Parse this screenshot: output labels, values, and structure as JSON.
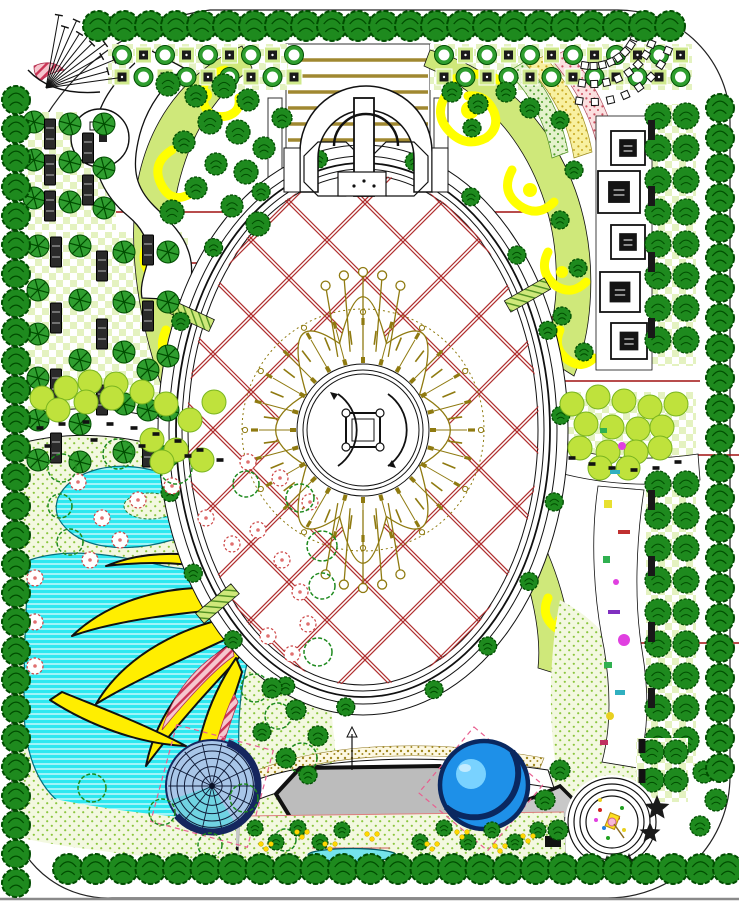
{
  "title": "landscape-master-plan",
  "canvas": {
    "width": 739,
    "height": 911
  },
  "palette": {
    "line": "#111111",
    "redLine": "#a01010",
    "latticeRed": "#b03030",
    "treeDark": "#1e8a1e",
    "treeDarkEdge": "#004d00",
    "treeMid": "#2f9e2f",
    "treeLight": "#bfe23c",
    "treeLightEdge": "#7ab520",
    "checkerLight": "#e4f2c0",
    "bandGreen": "#cfe87a",
    "yellow": "#ffee00",
    "swirlYellow": "#ffff00",
    "water": "#2ee8f0",
    "waterEdge": "#056c7c",
    "domeBase": "#a8c6e8",
    "domeRim": "#15265e",
    "domeCyan": "#58d8e0",
    "poolBlue": "#1e90e8",
    "poolLight": "#79d2ff",
    "poolRim": "#0a2860",
    "olive": "#8f7a10",
    "tan": "#a08830",
    "stageGray": "#bcbcbc",
    "walkGray": "#c8c8c8",
    "pinkFill": "#f6c6ce",
    "pinkEdge": "#cc3355",
    "vegBg": "#f3f8e0",
    "vegDot": "#8cc63f",
    "speckYellowBg": "#f8f0a0",
    "speckYellowDot": "#c8a820",
    "speckPinkBg": "#fbe0e0",
    "speckPinkDot": "#cc5060",
    "speckGreenBg": "#e4f2cc",
    "speckGreenDot": "#4e9e28",
    "magenta": "#e040e0",
    "khakiDot": "#a08820"
  },
  "features": {
    "treeBorders": [
      {
        "x": 98,
        "y": 26,
        "dx": 26,
        "dy": 0,
        "n": 23,
        "r": 15
      },
      {
        "x": 16,
        "y": 100,
        "dx": 0,
        "dy": 29,
        "n": 28,
        "r": 14
      },
      {
        "x": 720,
        "y": 108,
        "dx": 0,
        "dy": 30,
        "n": 23,
        "r": 14
      },
      {
        "x": 68,
        "y": 869,
        "dx": 27.5,
        "dy": 0,
        "n": 25,
        "r": 15
      }
    ],
    "topGrid": {
      "rows": [
        55,
        77
      ],
      "cell": 21.5,
      "runs": [
        {
          "x0": 112,
          "n": 9
        },
        {
          "x0": 434,
          "n": 12
        }
      ]
    },
    "leftGridBenches": [
      [
        56,
        252
      ],
      [
        56,
        318
      ],
      [
        56,
        384
      ],
      [
        56,
        448
      ],
      [
        102,
        266
      ],
      [
        102,
        334
      ],
      [
        102,
        400
      ],
      [
        148,
        250
      ],
      [
        148,
        316
      ],
      [
        148,
        452
      ],
      [
        50,
        134
      ],
      [
        50,
        170
      ],
      [
        50,
        206
      ],
      [
        88,
        148
      ],
      [
        88,
        190
      ]
    ],
    "leftGridStars": [
      [
        38,
        246
      ],
      [
        38,
        290
      ],
      [
        38,
        334
      ],
      [
        38,
        378
      ],
      [
        38,
        420
      ],
      [
        38,
        460
      ],
      [
        80,
        246
      ],
      [
        80,
        300
      ],
      [
        80,
        360
      ],
      [
        80,
        424
      ],
      [
        80,
        462
      ],
      [
        124,
        252
      ],
      [
        124,
        302
      ],
      [
        124,
        352
      ],
      [
        124,
        404
      ],
      [
        124,
        452
      ],
      [
        168,
        252
      ],
      [
        168,
        302
      ],
      [
        168,
        356
      ],
      [
        168,
        410
      ],
      [
        168,
        456
      ],
      [
        148,
        370
      ],
      [
        148,
        410
      ],
      [
        34,
        122
      ],
      [
        34,
        160
      ],
      [
        34,
        198
      ],
      [
        70,
        124
      ],
      [
        70,
        162
      ],
      [
        70,
        202
      ],
      [
        104,
        124
      ],
      [
        104,
        168
      ],
      [
        104,
        208
      ]
    ],
    "fan": {
      "ax": 46,
      "ay": 88,
      "a0": -80,
      "a1": -8,
      "n": 11,
      "len": 74
    },
    "pavilions": [
      [
        628,
        148,
        34
      ],
      [
        619,
        192,
        42
      ],
      [
        628,
        242,
        34
      ],
      [
        620,
        292,
        40
      ],
      [
        629,
        341,
        36
      ]
    ],
    "rightCols": {
      "xs": [
        658,
        686
      ],
      "runs": [
        {
          "y0": 116,
          "n": 8
        },
        {
          "y0": 484,
          "n": 9
        }
      ],
      "step": 32,
      "r": 13
    },
    "rightColBenches": [
      130,
      196,
      262,
      328,
      500,
      566,
      632,
      698
    ],
    "paverFan": {
      "cx": 592,
      "cy": 20,
      "radii": [
        46,
        64,
        82
      ],
      "a0": 22,
      "a1": 102,
      "step": 11,
      "s": 7
    },
    "lattice": {
      "cx": 363,
      "cy": 430,
      "spacing": 76
    },
    "rings": [
      [
        205,
        285
      ],
      [
        194,
        274
      ],
      [
        187,
        267
      ],
      [
        181,
        261
      ],
      [
        175,
        255
      ]
    ],
    "sunburst": {
      "cx": 363,
      "cy": 430,
      "rIn": 66,
      "rOut": 114,
      "rays": 24
    },
    "petals": {
      "cx": 363,
      "cy": 430,
      "rx": 118,
      "ry": 180,
      "n": 8,
      "vr": 0.52
    },
    "stems": {
      "angles": [
        246,
        258,
        270,
        282,
        294,
        66,
        78,
        90,
        102,
        114
      ],
      "rx": 92,
      "ry": 158,
      "tip": 4.5
    },
    "ringTrees": {
      "rx": 198,
      "ry": 278,
      "r": 9,
      "angles": [
        95,
        113,
        131,
        149,
        167,
        185,
        203,
        221,
        239,
        257,
        -75,
        -57,
        -39,
        -21,
        -3,
        15,
        33,
        51,
        69
      ]
    },
    "ringPlanters": {
      "rx": 190,
      "ry": 270,
      "angles": [
        140,
        205,
        -30
      ]
    },
    "domes": {
      "dome": {
        "cx": 212,
        "cy": 786,
        "r": 46
      },
      "pool": {
        "cx": 484,
        "cy": 785,
        "r": 44
      }
    },
    "spiral": {
      "cx": 612,
      "cy": 822,
      "radii": [
        44,
        38,
        32,
        26
      ],
      "confetti": [
        [
          600,
          810,
          "#d02020"
        ],
        [
          622,
          808,
          "#20a020"
        ],
        [
          604,
          828,
          "#2080e0"
        ],
        [
          624,
          830,
          "#e8d020"
        ],
        [
          596,
          820,
          "#e040e0"
        ],
        [
          618,
          818,
          "#d02020"
        ],
        [
          608,
          838,
          "#20a020"
        ],
        [
          600,
          800,
          "#e8d020"
        ]
      ]
    },
    "stars": [
      [
        657,
        808,
        13
      ],
      [
        650,
        833,
        11
      ],
      [
        607,
        867,
        12
      ],
      [
        629,
        862,
        9
      ]
    ],
    "flowers": [
      [
        78,
        482
      ],
      [
        102,
        518
      ],
      [
        138,
        500
      ],
      [
        172,
        486
      ],
      [
        206,
        518
      ],
      [
        232,
        544
      ],
      [
        258,
        530
      ],
      [
        282,
        560
      ],
      [
        300,
        592
      ],
      [
        308,
        624
      ],
      [
        292,
        654
      ],
      [
        268,
        636
      ],
      [
        35,
        578
      ],
      [
        35,
        622
      ],
      [
        35,
        666
      ],
      [
        248,
        462
      ],
      [
        280,
        478
      ],
      [
        310,
        502
      ],
      [
        120,
        540
      ],
      [
        90,
        560
      ]
    ],
    "shrubs": [
      [
        62,
        468,
        14
      ],
      [
        118,
        454,
        15
      ],
      [
        176,
        468,
        16
      ],
      [
        246,
        484,
        13
      ],
      [
        300,
        498,
        14
      ],
      [
        322,
        546,
        15
      ],
      [
        70,
        542,
        13
      ],
      [
        255,
        688,
        14
      ],
      [
        278,
        716,
        13
      ],
      [
        302,
        758,
        15
      ],
      [
        244,
        798,
        14
      ],
      [
        162,
        812,
        13
      ],
      [
        92,
        788,
        14
      ],
      [
        322,
        586,
        13
      ],
      [
        318,
        652,
        14
      ],
      [
        60,
        506,
        12
      ],
      [
        285,
        840,
        11
      ],
      [
        210,
        845,
        12
      ]
    ],
    "lightLeft": [
      [
        42,
        398
      ],
      [
        66,
        388
      ],
      [
        90,
        382
      ],
      [
        116,
        384
      ],
      [
        142,
        392
      ],
      [
        166,
        404
      ],
      [
        190,
        420
      ],
      [
        58,
        410
      ],
      [
        86,
        402
      ],
      [
        112,
        398
      ],
      [
        152,
        440
      ],
      [
        176,
        450
      ],
      [
        202,
        460
      ],
      [
        162,
        462
      ],
      [
        214,
        402
      ]
    ],
    "lightRight": [
      [
        572,
        404
      ],
      [
        598,
        397
      ],
      [
        624,
        401
      ],
      [
        650,
        407
      ],
      [
        676,
        404
      ],
      [
        586,
        424
      ],
      [
        612,
        427
      ],
      [
        638,
        429
      ],
      [
        662,
        427
      ],
      [
        580,
        448
      ],
      [
        608,
        452
      ],
      [
        636,
        452
      ],
      [
        660,
        448
      ],
      [
        600,
        468
      ],
      [
        628,
        468
      ]
    ],
    "midTrees": [
      [
        168,
        84,
        12
      ],
      [
        196,
        96,
        11
      ],
      [
        224,
        86,
        12
      ],
      [
        248,
        100,
        11
      ],
      [
        210,
        122,
        12
      ],
      [
        184,
        142,
        11
      ],
      [
        238,
        132,
        12
      ],
      [
        216,
        164,
        11
      ],
      [
        246,
        172,
        12
      ],
      [
        196,
        188,
        11
      ],
      [
        172,
        212,
        12
      ],
      [
        232,
        206,
        11
      ],
      [
        258,
        224,
        12
      ],
      [
        264,
        148,
        11
      ],
      [
        282,
        118,
        10
      ],
      [
        452,
        92,
        10
      ],
      [
        478,
        104,
        10
      ],
      [
        506,
        92,
        10
      ],
      [
        530,
        108,
        10
      ],
      [
        472,
        128,
        9
      ],
      [
        560,
        120,
        9
      ],
      [
        574,
        170,
        9
      ],
      [
        560,
        220,
        9
      ],
      [
        578,
        268,
        9
      ],
      [
        562,
        316,
        9
      ],
      [
        584,
        352,
        9
      ],
      [
        272,
        688,
        10
      ],
      [
        296,
        710,
        10
      ],
      [
        318,
        736,
        10
      ],
      [
        262,
        732,
        9
      ],
      [
        286,
        758,
        10
      ],
      [
        308,
        775,
        9
      ],
      [
        704,
        772,
        11
      ],
      [
        716,
        800,
        11
      ],
      [
        700,
        826,
        10
      ],
      [
        560,
        770,
        10
      ],
      [
        545,
        800,
        10
      ],
      [
        558,
        830,
        10
      ]
    ],
    "brGrid": {
      "bg": [
        636,
        738,
        52,
        64
      ],
      "trees": [
        [
          652,
          752
        ],
        [
          676,
          752
        ],
        [
          652,
          780
        ],
        [
          676,
          780
        ]
      ],
      "planters": [
        [
          642,
          746
        ],
        [
          642,
          776
        ]
      ]
    },
    "bedTrees": [
      [
        255,
        828
      ],
      [
        276,
        842
      ],
      [
        298,
        828
      ],
      [
        320,
        842
      ],
      [
        342,
        830
      ],
      [
        420,
        842
      ],
      [
        444,
        828
      ],
      [
        468,
        842
      ],
      [
        492,
        830
      ],
      [
        515,
        842
      ],
      [
        538,
        830
      ]
    ],
    "bedDots": [
      [
        266,
        846
      ],
      [
        302,
        834
      ],
      [
        330,
        846
      ],
      [
        432,
        846
      ],
      [
        462,
        834
      ],
      [
        500,
        848
      ],
      [
        528,
        838
      ],
      [
        372,
        836
      ]
    ],
    "dashesCobble": [
      [
        40,
        428
      ],
      [
        62,
        424
      ],
      [
        86,
        422
      ],
      [
        110,
        424
      ],
      [
        134,
        428
      ],
      [
        156,
        434
      ],
      [
        178,
        441
      ],
      [
        200,
        450
      ],
      [
        220,
        460
      ],
      [
        48,
        446
      ],
      [
        94,
        440
      ],
      [
        142,
        446
      ],
      [
        188,
        456
      ]
    ],
    "dashesRight": [
      [
        572,
        458
      ],
      [
        592,
        464
      ],
      [
        612,
        468
      ],
      [
        634,
        470
      ],
      [
        656,
        468
      ],
      [
        678,
        462
      ]
    ],
    "colorBits": [
      {
        "t": "r",
        "x": 600,
        "y": 428,
        "w": 7,
        "h": 5,
        "c": "#30b050"
      },
      {
        "t": "c",
        "x": 622,
        "y": 446,
        "r": 4,
        "c": "#e040e0"
      },
      {
        "t": "r",
        "x": 610,
        "y": 470,
        "w": 10,
        "h": 4,
        "c": "#30b0c0"
      },
      {
        "t": "r",
        "x": 604,
        "y": 500,
        "w": 8,
        "h": 8,
        "c": "#e8e030"
      },
      {
        "t": "r",
        "x": 618,
        "y": 530,
        "w": 12,
        "h": 4,
        "c": "#c03030"
      },
      {
        "t": "r",
        "x": 603,
        "y": 556,
        "w": 7,
        "h": 7,
        "c": "#30b050"
      },
      {
        "t": "c",
        "x": 616,
        "y": 582,
        "r": 3,
        "c": "#e040e0"
      },
      {
        "t": "r",
        "x": 608,
        "y": 610,
        "w": 12,
        "h": 4,
        "c": "#8030c0"
      },
      {
        "t": "c",
        "x": 624,
        "y": 640,
        "r": 6,
        "c": "#e040e0"
      },
      {
        "t": "r",
        "x": 604,
        "y": 662,
        "w": 8,
        "h": 6,
        "c": "#30b050"
      },
      {
        "t": "r",
        "x": 615,
        "y": 690,
        "w": 10,
        "h": 5,
        "c": "#30b0c0"
      },
      {
        "t": "c",
        "x": 610,
        "y": 716,
        "r": 4,
        "c": "#e8d020"
      },
      {
        "t": "r",
        "x": 600,
        "y": 740,
        "w": 8,
        "h": 5,
        "c": "#c03060"
      }
    ],
    "redLines": [
      [
        58,
        212,
        570,
        212
      ],
      [
        160,
        263,
        226,
        263
      ],
      [
        160,
        368,
        226,
        368
      ],
      [
        440,
        317,
        560,
        317
      ],
      [
        560,
        381,
        700,
        381
      ],
      [
        575,
        455,
        739,
        455
      ],
      [
        23,
        470,
        23,
        712
      ],
      [
        590,
        643,
        739,
        643
      ],
      [
        60,
        544,
        160,
        544
      ]
    ]
  }
}
